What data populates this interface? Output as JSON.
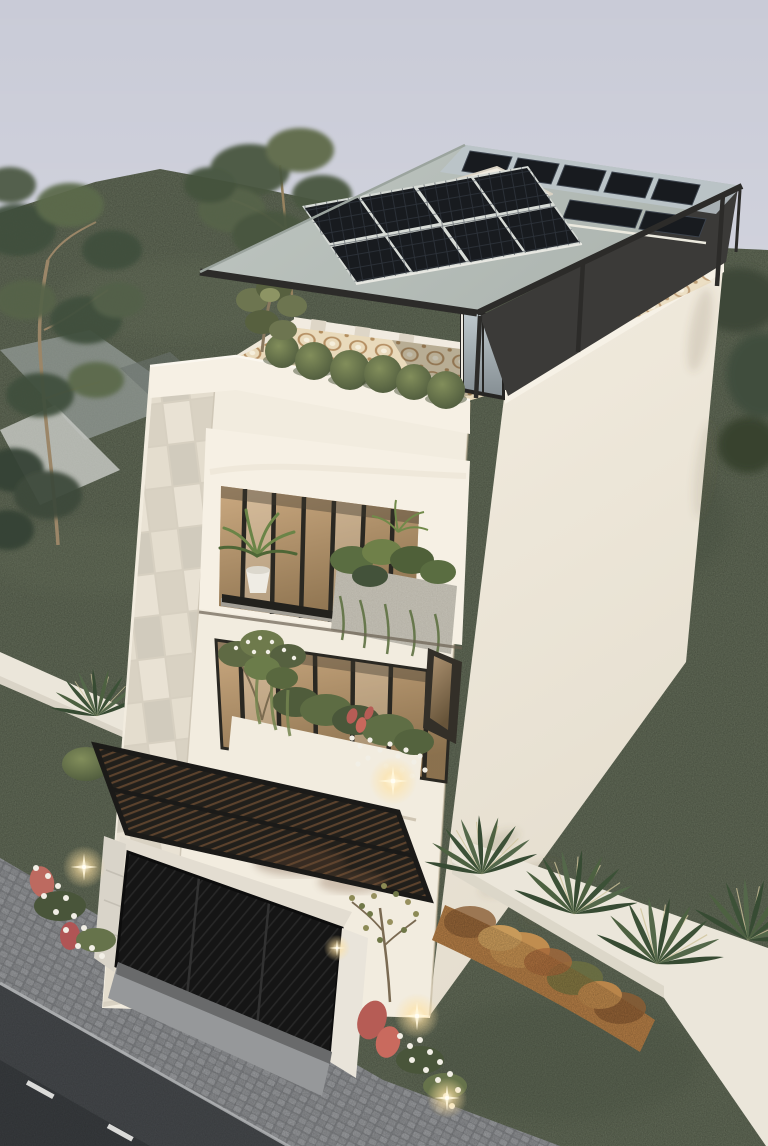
{
  "scene": {
    "subject": "aerial-dusk-render-modern-three-storey-house",
    "features": [
      "rooftop-solar-canopy",
      "tilted-solar-array",
      "flat-solar-array",
      "skylight-box",
      "dark-roof-deck",
      "roof-terrace",
      "mosaic-tile-floor",
      "terrace-bushes",
      "glass-balustrade",
      "glass-door",
      "second-floor-balcony",
      "amber-window-walls",
      "potted-palm",
      "hanging-planter",
      "first-floor-flower-planter",
      "black-louver-pergola",
      "perforated-garage-gate",
      "wall-lamp",
      "stone-clad-side-wall",
      "boundary-walls",
      "orange-flower-hedge",
      "fan-palms",
      "eucalyptus-trees",
      "cobblestone-sidewalk",
      "asphalt-road-lane-markings",
      "garden-uplights",
      "lawns"
    ]
  },
  "palette": {
    "sky": "#c9cbd7",
    "grass": "#59624f",
    "grassShade": "#49544472",
    "treeDark": "#41503c",
    "treeLight": "#5c6a4c",
    "houseWhite": "#f2ecdf",
    "houseBright": "#f6f0e4",
    "stoneTile": "#e2dbcc",
    "canopyTop": "#b7bfba",
    "roofDeck": "#3b3a38",
    "darkMetal": "#2c2b29",
    "solarPanel": "#181b1f",
    "glass": "#bcc6ca",
    "mosaicBase": "#e9dabb",
    "amberGlass": "#bb9a72",
    "plantGreen": "#66734b",
    "plantDeep": "#49553a",
    "planterConcrete": "#b4b0a5",
    "pergola": "#211f1b",
    "gateDark": "#151515",
    "sidewalk": "#7e8083",
    "road": "#434649",
    "roadDark": "#35383b",
    "laneMark": "#e9e9e7",
    "curb": "#b5b7b9",
    "driveway": "#96989a",
    "fenceWhite": "#ebe6da",
    "hedgeOrange": "#b27c45",
    "flowerWhite": "#f2efe6",
    "flowerRed": "#b65c55",
    "warmLight": "#ffe9b8"
  }
}
